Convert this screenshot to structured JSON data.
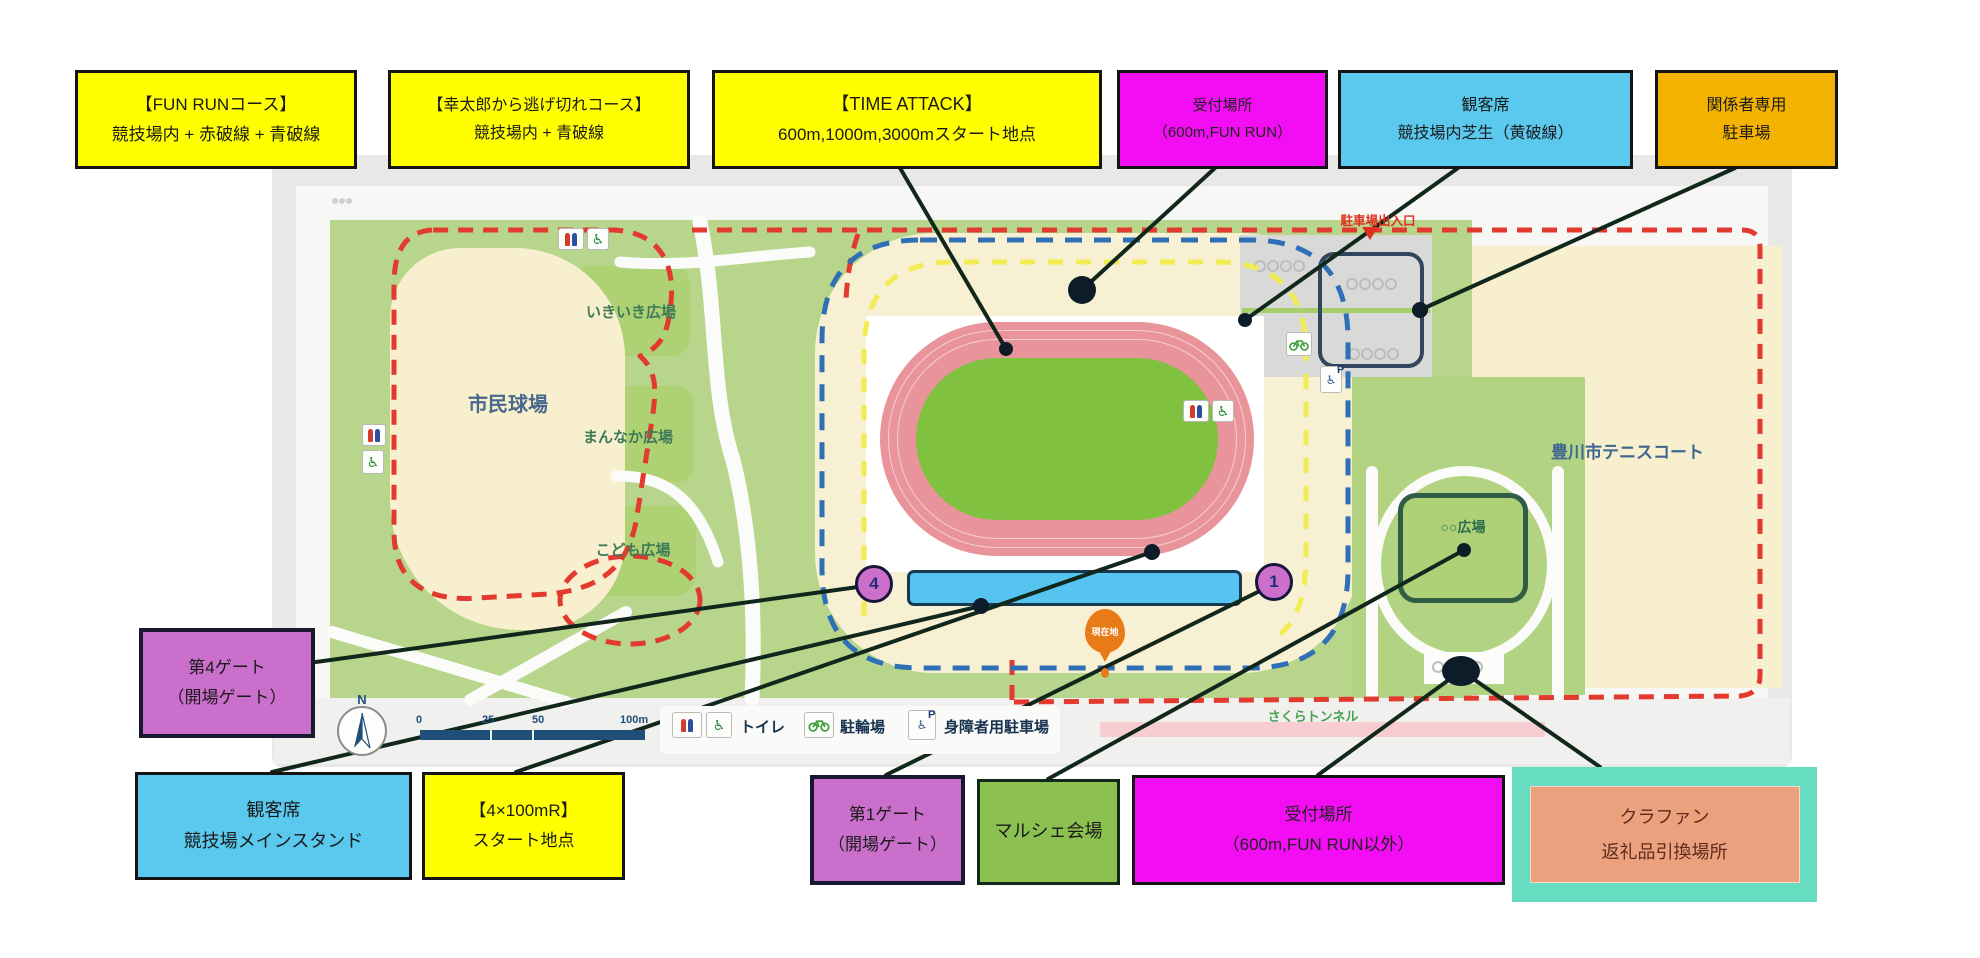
{
  "labels": {
    "top": [
      {
        "line1": "【FUN RUNコース】",
        "line2": "競技場内 + 赤破線 + 青破線"
      },
      {
        "line1": "【幸太郎から逃げ切れコース】",
        "line2": "競技場内 + 青破線"
      },
      {
        "line1": "【TIME ATTACK】",
        "line2": "600m,1000m,3000mスタート地点"
      },
      {
        "line1": "受付場所",
        "line2": "（600m,FUN RUN）"
      },
      {
        "line1": "観客席",
        "line2": "競技場内芝生（黄破線）"
      },
      {
        "line1": "関係者専用",
        "line2": "駐車場"
      }
    ],
    "bottom": [
      {
        "line1": "第4ゲート",
        "line2": "（開場ゲート）"
      },
      {
        "line1": "観客席",
        "line2": "競技場メインスタンド"
      },
      {
        "line1": "【4×100mR】",
        "line2": "スタート地点"
      },
      {
        "line1": "第1ゲート",
        "line2": "（開場ゲート）"
      },
      {
        "line1": "マルシェ会場"
      },
      {
        "line1": "受付場所",
        "line2": "（600m,FUN RUN以外）"
      },
      {
        "line1": "クラファン",
        "line2": "返礼品引換場所"
      }
    ]
  },
  "map": {
    "areas": {
      "baseball": "市民球場",
      "ikiiki": "いきいき広場",
      "mannaka": "まんなか広場",
      "kodomo": "こども広場",
      "tennis": "豊川市テニスコート",
      "plaza": "○○広場",
      "sakura": "さくらトンネル",
      "parking_exit": "駐車場出入口",
      "current": "現在地"
    },
    "gates": {
      "gate4": "4",
      "gate1": "1"
    },
    "legend": {
      "toilet": "トイレ",
      "bicycle": "駐輪場",
      "accessible": "身障者用駐車場"
    },
    "scale_ticks": [
      "0",
      "25",
      "50",
      "100m"
    ],
    "compass_n": "N"
  },
  "colors": {
    "label_yellow": "#ffff00",
    "label_magenta": "#f20df2",
    "label_skyblue": "#5bc8ee",
    "label_orange": "#f5b301",
    "label_purple": "#ca70cc",
    "label_green": "#8cc152",
    "label_teal": "#66dcc1",
    "label_salmon": "#eba17e",
    "route_red_dash": "#e23a2e",
    "route_blue_dash": "#2f6fb5",
    "route_yellow_dash": "#f1ec52",
    "park_green": "#b7d68c",
    "field_cream": "#f7efce",
    "track_pink": "#e9939b",
    "infield_green": "#80c23f",
    "stand_blue": "#56c4f0",
    "scalebar_navy": "#1f4e79"
  }
}
